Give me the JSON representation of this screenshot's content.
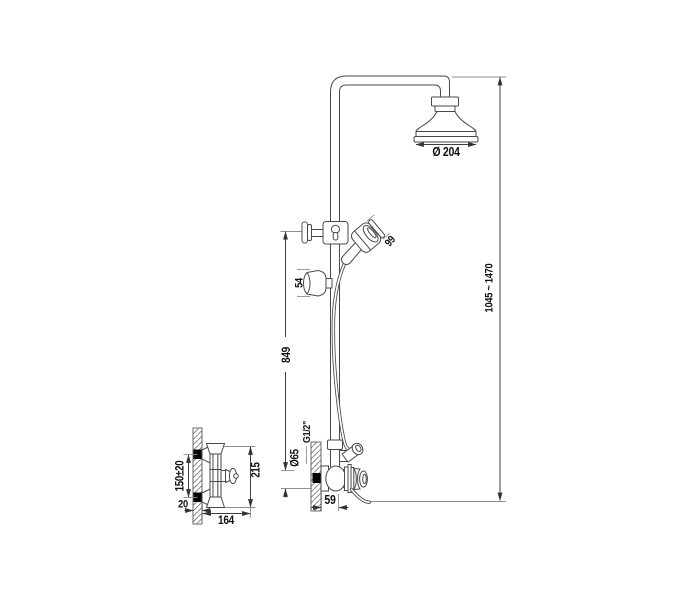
{
  "drawing": {
    "type": "technical-installation-diagram",
    "subject": "shower-column-with-rain-head-hand-shower-and-wall-mixer",
    "dims": {
      "head_diameter": "Ø 204",
      "height_range": "1045 ~ 1470",
      "rail_length": "849",
      "handshower_head_width": "66",
      "holder_diameter": "54",
      "escutcheon_diameter": "Ø65",
      "connection_thread": "G1/2\"",
      "valve_center_offset": "59",
      "valve_body_height": "215",
      "mounting_distance": "150±20",
      "wall_plate_depth": "20",
      "valve_depth": "164"
    },
    "colors": {
      "line": "#4a4a4a",
      "dim_line": "#3f3f3f",
      "extension_line": "#8f8f8f",
      "text": "#111111",
      "wall_anchor": "#000000",
      "background": "#ffffff"
    }
  }
}
